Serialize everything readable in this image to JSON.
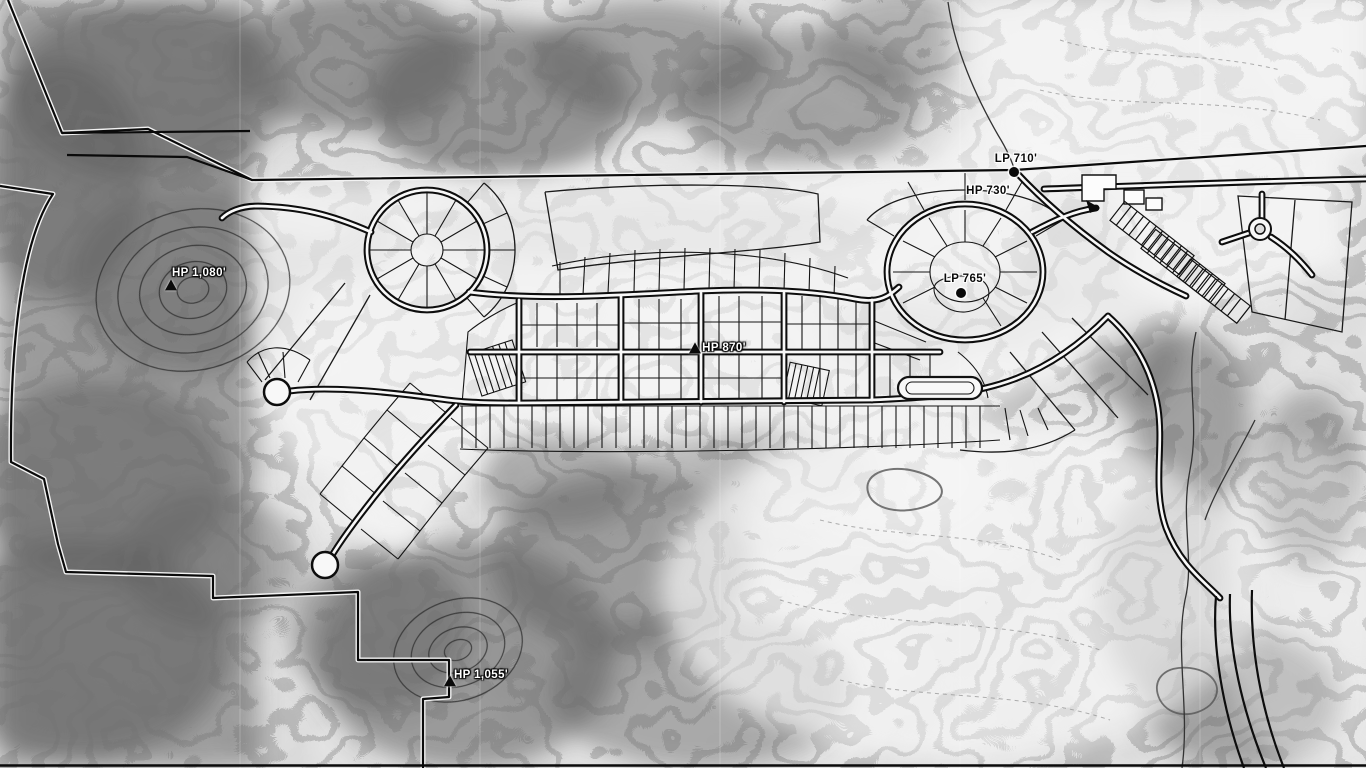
{
  "map": {
    "description": "Grayscale topographic site plan with subdivision road and lot layout",
    "colors": {
      "paper": "#e9e9e9",
      "ink": "#101010",
      "road_core": "#f8f8f8",
      "terrain_shade": "#5a5a5a",
      "label_light": "#ffffff",
      "label_dark": "#0a0a0a"
    },
    "markers": [
      {
        "name": "hp-1080",
        "label": "HP 1,080'",
        "kind": "high-point",
        "tone": "light",
        "x": 171,
        "y": 286,
        "lx": 199,
        "ly": 273
      },
      {
        "name": "lp-710",
        "label": "LP 710'",
        "kind": "low-point",
        "tone": "dark",
        "x": 1014,
        "y": 172,
        "lx": 1016,
        "ly": 159
      },
      {
        "name": "hp-730",
        "label": "HP 730'",
        "kind": "label-only",
        "tone": "dark",
        "x": 988,
        "y": 191,
        "lx": 988,
        "ly": 191
      },
      {
        "name": "lp-765",
        "label": "LP 765'",
        "kind": "low-point",
        "tone": "dark",
        "x": 961,
        "y": 293,
        "lx": 965,
        "ly": 279
      },
      {
        "name": "hp-870",
        "label": "HP 870'",
        "kind": "high-point",
        "tone": "light",
        "x": 695,
        "y": 349,
        "lx": 724,
        "ly": 348
      },
      {
        "name": "hp-1055",
        "label": "HP 1,055'",
        "kind": "high-point",
        "tone": "light",
        "x": 450,
        "y": 682,
        "lx": 481,
        "ly": 675
      }
    ]
  }
}
